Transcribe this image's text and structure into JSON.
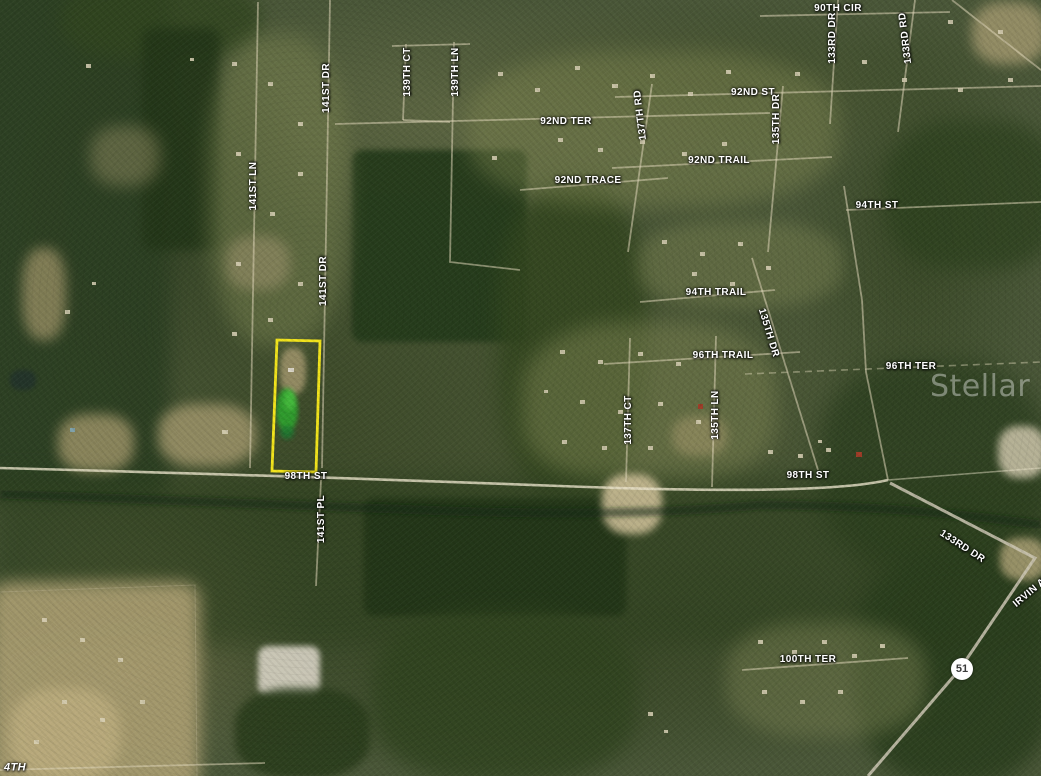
{
  "map": {
    "watermark": "Stellar MLS",
    "highway_shield": "51",
    "parcel_outline_color": "#F2E41C",
    "street_labels": [
      {
        "text": "90TH CIR",
        "x": 838,
        "y": 9,
        "rot": 0
      },
      {
        "text": "92ND ST",
        "x": 753,
        "y": 93,
        "rot": 0
      },
      {
        "text": "92ND TER",
        "x": 566,
        "y": 122,
        "rot": 0
      },
      {
        "text": "92ND TRAIL",
        "x": 719,
        "y": 161,
        "rot": 0
      },
      {
        "text": "92ND TRACE",
        "x": 588,
        "y": 181,
        "rot": 0
      },
      {
        "text": "94TH ST",
        "x": 877,
        "y": 206,
        "rot": 0
      },
      {
        "text": "94TH TRAIL",
        "x": 716,
        "y": 293,
        "rot": 0
      },
      {
        "text": "96TH TRAIL",
        "x": 723,
        "y": 356,
        "rot": 0
      },
      {
        "text": "96TH TER",
        "x": 911,
        "y": 367,
        "rot": 0
      },
      {
        "text": "98TH ST",
        "x": 306,
        "y": 477,
        "rot": 0
      },
      {
        "text": "98TH ST",
        "x": 808,
        "y": 476,
        "rot": 0
      },
      {
        "text": "100TH TER",
        "x": 808,
        "y": 660,
        "rot": 0
      },
      {
        "text": "141ST LN",
        "x": 254,
        "y": 186,
        "rot": -90
      },
      {
        "text": "141ST DR",
        "x": 327,
        "y": 88,
        "rot": -90
      },
      {
        "text": "141ST DR",
        "x": 324,
        "y": 281,
        "rot": -90
      },
      {
        "text": "141ST PL",
        "x": 322,
        "y": 519,
        "rot": -90
      },
      {
        "text": "139TH CT",
        "x": 408,
        "y": 72,
        "rot": -90
      },
      {
        "text": "139TH LN",
        "x": 456,
        "y": 72,
        "rot": -90
      },
      {
        "text": "137TH RD",
        "x": 641,
        "y": 115,
        "rot": -97
      },
      {
        "text": "135TH DR",
        "x": 777,
        "y": 119,
        "rot": -90
      },
      {
        "text": "133RD DR",
        "x": 833,
        "y": 38,
        "rot": -90
      },
      {
        "text": "133RD RD",
        "x": 906,
        "y": 38,
        "rot": -97
      },
      {
        "text": "137TH CT",
        "x": 629,
        "y": 420,
        "rot": -90
      },
      {
        "text": "135TH LN",
        "x": 716,
        "y": 415,
        "rot": -90
      },
      {
        "text": "135TH DR",
        "x": 768,
        "y": 333,
        "rot": 73
      },
      {
        "text": "133RD DR",
        "x": 962,
        "y": 547,
        "rot": 33
      },
      {
        "text": "IRVIN AVE",
        "x": 1035,
        "y": 589,
        "rot": -40
      },
      {
        "text": "4TH",
        "x": 15,
        "y": 768,
        "rot": 0,
        "italic": true
      }
    ]
  }
}
